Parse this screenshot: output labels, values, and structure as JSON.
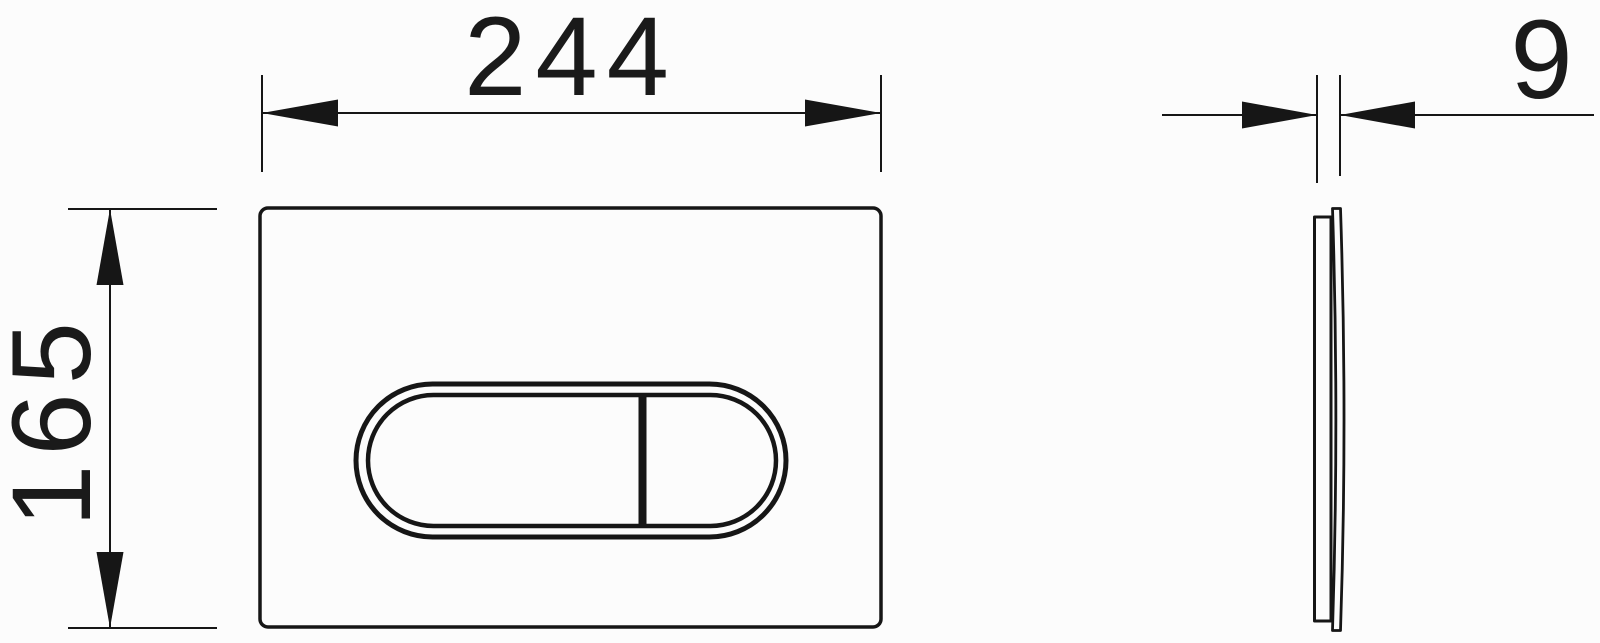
{
  "drawing": {
    "dimensions": {
      "width_label": "244",
      "height_label": "165",
      "thickness_label": "9"
    },
    "colors": {
      "line": "#161616",
      "background": "#fcfcfc"
    }
  }
}
